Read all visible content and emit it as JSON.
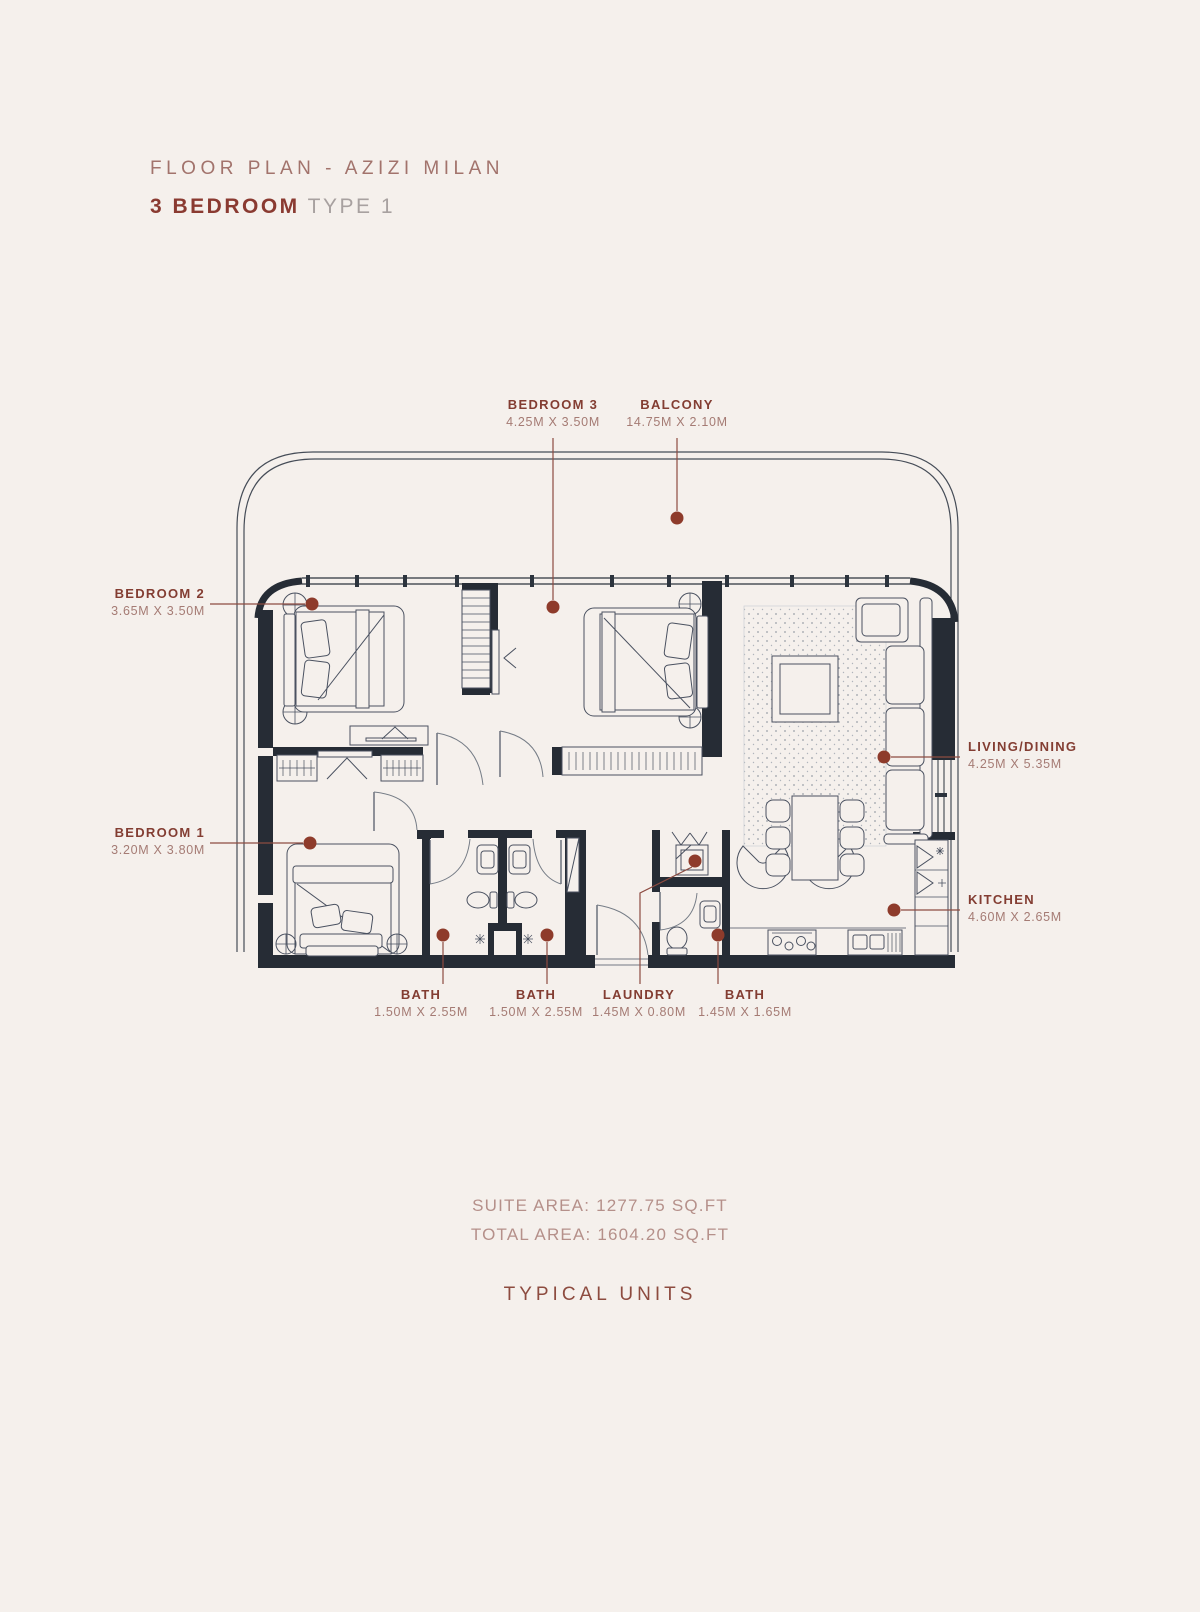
{
  "header": {
    "line1": "FLOOR PLAN - AZIZI MILAN",
    "line2_bold": "3 BEDROOM",
    "line2_rest": " TYPE 1"
  },
  "rooms": [
    {
      "id": "bedroom3",
      "name": "BEDROOM 3",
      "dims": "4.25M X 3.50M"
    },
    {
      "id": "balcony",
      "name": "BALCONY",
      "dims": "14.75M X 2.10M"
    },
    {
      "id": "bedroom2",
      "name": "BEDROOM 2",
      "dims": "3.65M X 3.50M"
    },
    {
      "id": "living",
      "name": "LIVING/DINING",
      "dims": "4.25M X 5.35M"
    },
    {
      "id": "bedroom1",
      "name": "BEDROOM 1",
      "dims": "3.20M X 3.80M"
    },
    {
      "id": "kitchen",
      "name": "KITCHEN",
      "dims": "4.60M X 2.65M"
    },
    {
      "id": "bath1",
      "name": "BATH",
      "dims": "1.50M X 2.55M"
    },
    {
      "id": "bath2",
      "name": "BATH",
      "dims": "1.50M X 2.55M"
    },
    {
      "id": "laundry",
      "name": "LAUNDRY",
      "dims": "1.45M X 0.80M"
    },
    {
      "id": "bath3",
      "name": "BATH",
      "dims": "1.45M X 1.65M"
    }
  ],
  "areas": {
    "suite": "SUITE AREA: 1277.75 SQ.FT",
    "total": "TOTAL AREA: 1604.20 SQ.FT"
  },
  "footer": {
    "caption": "TYPICAL UNITS"
  },
  "colors": {
    "background": "#f5f0ec",
    "wall": "#262c35",
    "furniture_line": "#4a5160",
    "rail_line": "#454c57",
    "label": "#833d32",
    "dims": "#a57b74",
    "leader": "#8d4b41",
    "marker_dot": "#8e3b2b",
    "title_muted": "#a2736c",
    "title_bold": "#8a3a31",
    "area_text": "#b5908a",
    "caption_text": "#8d4b3f"
  }
}
